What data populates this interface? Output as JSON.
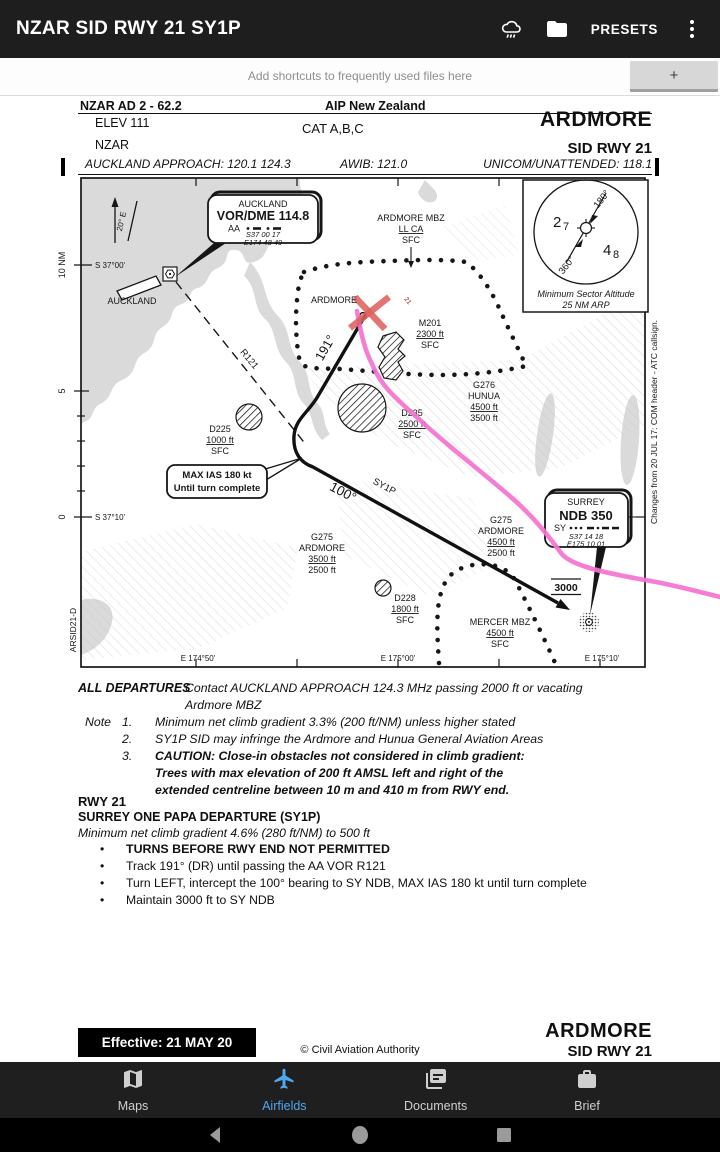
{
  "app_bar": {
    "title": "NZAR SID RWY 21 SY1P",
    "presets_label": "PRESETS"
  },
  "shortcut_bar": {
    "hint": "Add shortcuts to frequently used files here",
    "add_label": "+"
  },
  "doc": {
    "header": {
      "doc_ref": "NZAR AD 2 - 62.2",
      "aip": "AIP New Zealand",
      "elev": "ELEV 111",
      "cat": "CAT A,B,C",
      "airport": "ARDMORE",
      "icao": "NZAR",
      "procedure": "SID RWY 21",
      "freq_left": "AUCKLAND APPROACH: 120.1  124.3",
      "freq_center": "AWIB: 121.0",
      "freq_right": "UNICOM/UNATTENDED: 118.1"
    },
    "map": {
      "graticule": {
        "lat1": "S 37°00'",
        "lat2": "S 37°10'",
        "lon1": "E 174°50'",
        "lon2": "E 175°00'",
        "lon3": "E 175°10'",
        "scale10": "10 NM",
        "scale5": "5",
        "scale0": "0"
      },
      "side": {
        "chart_id": "ARSID21-D",
        "changes": "Changes from 20 JUL 17: COM header - ATC callsign."
      },
      "variation": "20° E",
      "auckland_city": "AUCKLAND",
      "ardmore_airport": "ARDMORE",
      "rwy_mark": "21",
      "vor_box": {
        "name": "AUCKLAND",
        "ident": "VOR/DME 114.8",
        "code": "AA",
        "lat": "S37 00 17",
        "lon": "E174 48 49"
      },
      "ndb_box": {
        "name": "SURREY",
        "ident": "NDB 350",
        "code": "SY",
        "lat": "S37 14 18",
        "lon": "E175 10 01"
      },
      "msa": {
        "sector_high": "180°",
        "sector_low": "360°",
        "alt_west_main": "2",
        "alt_west_sub": "7",
        "alt_east_main": "4",
        "alt_east_sub": "8",
        "caption1": "Minimum Sector Altitude",
        "caption2": "25 NM ARP"
      },
      "track": {
        "leg1": "191°",
        "leg2": "100°",
        "sid": "SY1P",
        "alt": "3000",
        "radial": "R121",
        "callout1": "MAX IAS 180 kt",
        "callout2": "Until turn complete"
      },
      "airspace": {
        "ardmore_mbz": [
          "ARDMORE MBZ",
          "LL CA",
          "SFC"
        ],
        "m201": [
          "M201",
          "2300 ft",
          "SFC"
        ],
        "g276": [
          "G276",
          "HUNUA",
          "4500 ft",
          "3500 ft"
        ],
        "d235": [
          "D235",
          "2500 ft",
          "SFC"
        ],
        "d225": [
          "D225",
          "1000 ft",
          "SFC"
        ],
        "g275_west": [
          "G275",
          "ARDMORE",
          "3500 ft",
          "2500 ft"
        ],
        "g275_east": [
          "G275",
          "ARDMORE",
          "4500 ft",
          "2500 ft"
        ],
        "d228": [
          "D228",
          "1800 ft",
          "SFC"
        ],
        "mercer_mbz": [
          "MERCER MBZ",
          "4500 ft",
          "SFC"
        ]
      }
    },
    "all_departures": {
      "label": "ALL DEPARTURES",
      "line1": "Contact AUCKLAND APPROACH 124.3 MHz passing 2000 ft or vacating",
      "line2": "Ardmore MBZ"
    },
    "notes": {
      "label": "Note",
      "n1_num": "1.",
      "n1": "Minimum net climb gradient 3.3% (200 ft/NM) unless higher stated",
      "n2_num": "2.",
      "n2": "SY1P SID may infringe the Ardmore and Hunua General Aviation Areas",
      "n3_num": "3.",
      "n3a": "CAUTION: Close-in obstacles not considered in climb gradient:",
      "n3b": "Trees with max elevation of 200 ft AMSL left and right of the",
      "n3c": "extended centreline between 10 m and 410 m from RWY end."
    },
    "rwy": {
      "title": "RWY 21",
      "name": "SURREY ONE PAPA DEPARTURE (SY1P)",
      "gradient": "Minimum net climb gradient 4.6% (280 ft/NM) to 500 ft",
      "bullet": "•",
      "b1": "TURNS BEFORE RWY END NOT PERMITTED",
      "b2": "Track 191° (DR) until passing the AA VOR R121",
      "b3": "Turn LEFT, intercept the 100° bearing to SY NDB, MAX IAS 180 kt until turn complete",
      "b4": "Maintain 3000 ft to SY NDB"
    },
    "footer": {
      "effective": "Effective: 21 MAY 20",
      "copyright": "© Civil Aviation Authority",
      "airport": "ARDMORE",
      "procedure": "SID RWY 21"
    }
  },
  "bottom_nav": {
    "items": [
      {
        "label": "Maps"
      },
      {
        "label": "Airfields"
      },
      {
        "label": "Documents"
      },
      {
        "label": "Brief"
      }
    ],
    "active": "Airfields"
  },
  "colors": {
    "accent": "#4FA7EF",
    "track_magenta": "#F473D0",
    "airport_red": "#DD625F"
  }
}
